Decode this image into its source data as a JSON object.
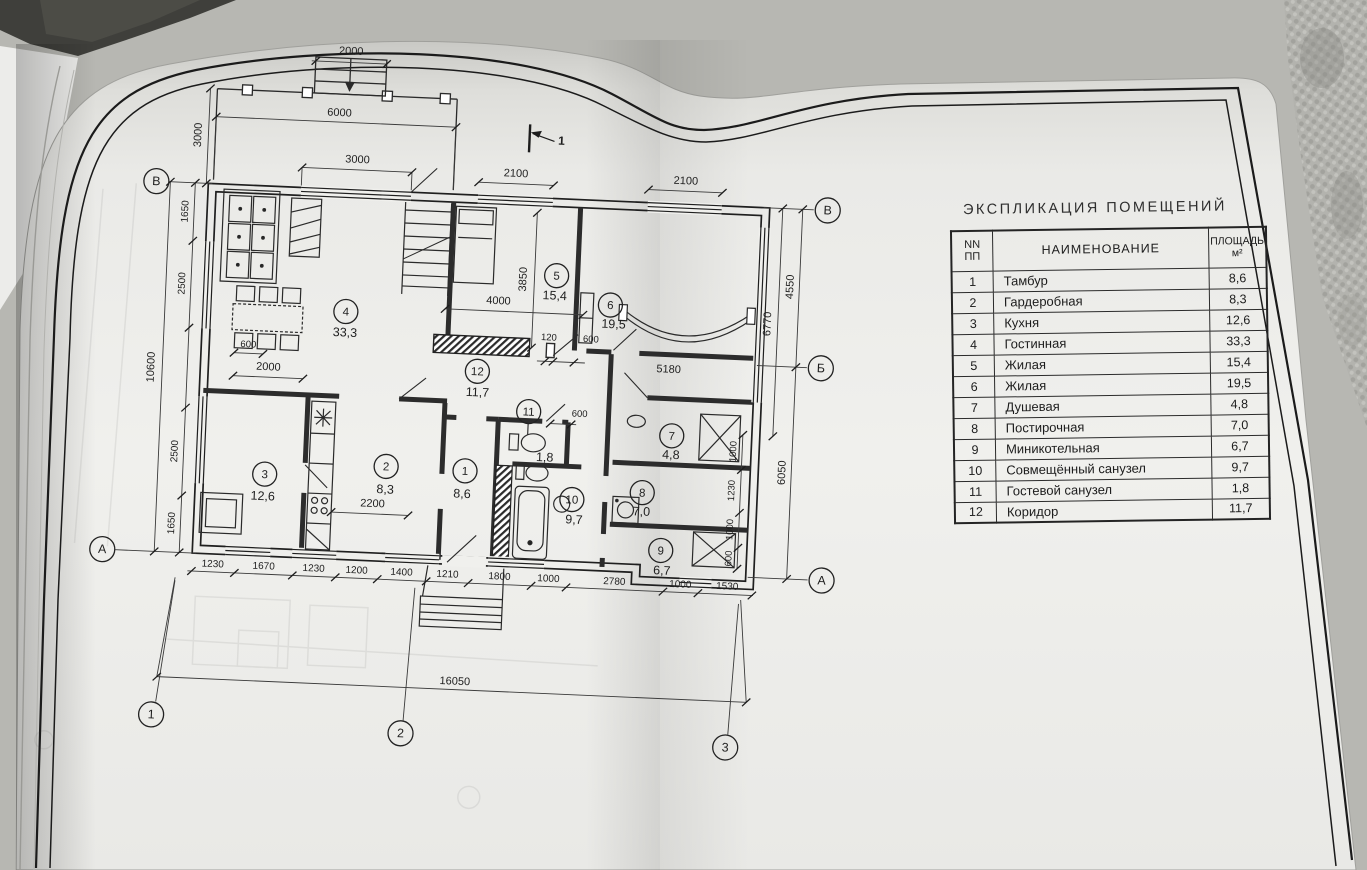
{
  "colors": {
    "paper": "#efefec",
    "ink": "#222222",
    "background_texture": "#b3b3ae",
    "book_cover_dark": "#3f3f3b"
  },
  "table": {
    "title": "ЭКСПЛИКАЦИЯ  ПОМЕЩЕНИЙ",
    "headers": {
      "num": "NN\nПП",
      "name": "НАИМЕНОВАНИЕ",
      "area": "ПЛОЩАДЬ\nм²"
    },
    "rows": [
      {
        "num": "1",
        "name": "Тамбур",
        "area": "8,6"
      },
      {
        "num": "2",
        "name": "Гардеробная",
        "area": "8,3"
      },
      {
        "num": "3",
        "name": "Кухня",
        "area": "12,6"
      },
      {
        "num": "4",
        "name": "Гостинная",
        "area": "33,3"
      },
      {
        "num": "5",
        "name": "Жилая",
        "area": "15,4"
      },
      {
        "num": "6",
        "name": "Жилая",
        "area": "19,5"
      },
      {
        "num": "7",
        "name": "Душевая",
        "area": "4,8"
      },
      {
        "num": "8",
        "name": "Постирочная",
        "area": "7,0"
      },
      {
        "num": "9",
        "name": "Миникотельная",
        "area": "6,7"
      },
      {
        "num": "10",
        "name": "Совмещённый санузел",
        "area": "9,7"
      },
      {
        "num": "11",
        "name": "Гостевой санузел",
        "area": "1,8"
      },
      {
        "num": "12",
        "name": "Коридор",
        "area": "11,7"
      }
    ]
  },
  "plan": {
    "section_mark": "1",
    "axes": {
      "left_top": "В",
      "left_bottom": "А",
      "right_top": "В",
      "right_middle": "Б",
      "right_bottom": "А",
      "bottom": [
        "1",
        "2",
        "3"
      ]
    },
    "rooms": [
      {
        "num": "1",
        "area": "8,6"
      },
      {
        "num": "2",
        "area": "8,3"
      },
      {
        "num": "3",
        "area": "12,6"
      },
      {
        "num": "4",
        "area": "33,3"
      },
      {
        "num": "5",
        "area": "15,4"
      },
      {
        "num": "6",
        "area": "19,5"
      },
      {
        "num": "7",
        "area": "4,8"
      },
      {
        "num": "8",
        "area": "7,0"
      },
      {
        "num": "9",
        "area": "6,7"
      },
      {
        "num": "10",
        "area": "9,7"
      },
      {
        "num": "11",
        "area": "1,8"
      },
      {
        "num": "12",
        "area": "11,7"
      }
    ],
    "dims": {
      "porch_width": "2000",
      "top_overall": "6000",
      "porch_depth": "3000",
      "living_window": "3000",
      "bedroom_window": "2100",
      "room6_window": "2100",
      "bay_window": "5180",
      "fireplace_wall": "4000",
      "bedroom_depth": "3850",
      "stub": "120",
      "corridor_door_upper": "600",
      "corridor_door_lower": "600",
      "dining_clearance": "600",
      "kitchen_wall": "2000",
      "wardrobe_wall": "2200",
      "left_overall": "10600",
      "left_chain": [
        "1650",
        "2500",
        "2500",
        "1650"
      ],
      "right_upper": "4550",
      "right_inner": "6770",
      "right_lower": "6050",
      "right_chain": [
        "1000",
        "1230",
        "1000",
        "600"
      ],
      "bottom_chain": [
        "1230",
        "1670",
        "1230",
        "1200",
        "1400",
        "1210",
        "1800",
        "1000",
        "2780",
        "1000",
        "1530"
      ],
      "bottom_overall": "16050"
    }
  }
}
